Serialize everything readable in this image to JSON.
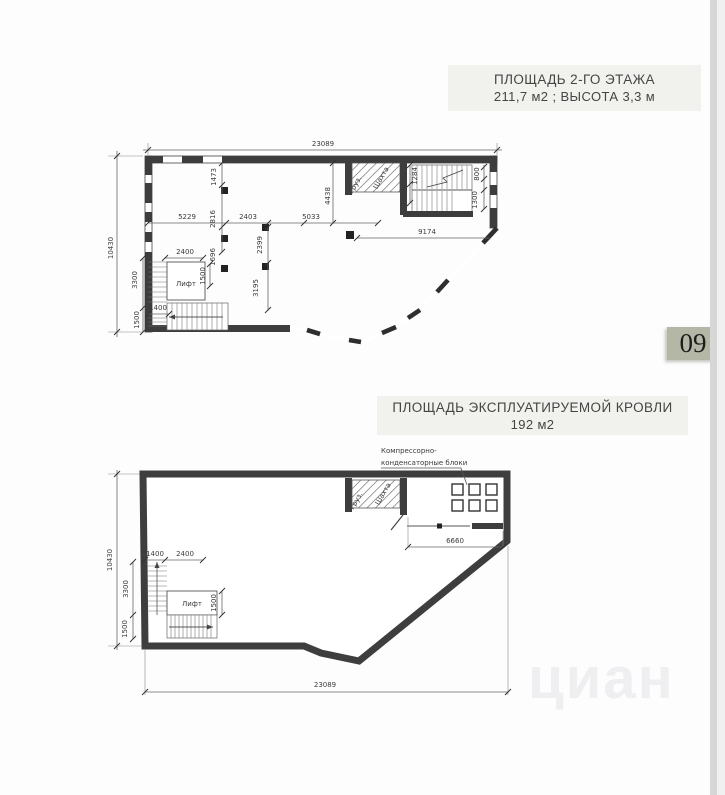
{
  "page": {
    "number": "09",
    "watermark": "циан",
    "colors": {
      "title_bg": "#f1f1ee",
      "badge_bg": "#b5b7a6",
      "wall": "#3d3d3d"
    }
  },
  "floor2": {
    "title_line1": "ПЛОЩАДЬ 2-ГО ЭТАЖА",
    "title_line2": "211,7 м2 ; ВЫСОТА 3,3 м",
    "labels": {
      "lift": "Лифт",
      "cargo": "Груз.",
      "shaft": "Шахта"
    },
    "dims": {
      "w23089": "23089",
      "h10430": "10430",
      "d5229": "5229",
      "d2816": "2816",
      "d2403": "2403",
      "d5033": "5033",
      "d1473": "1473",
      "d4438": "4438",
      "d1696": "1696",
      "d2399": "2399",
      "d3195": "3195",
      "d2400": "2400",
      "d1500": "1500",
      "d1400": "1400",
      "d3300": "3300",
      "d1284": "1284",
      "d800": "800",
      "d1300": "1300",
      "d9174": "9174"
    }
  },
  "roof": {
    "title_line1": "ПЛОЩАДЬ ЭКСПЛУАТИРУЕМОЙ КРОВЛИ",
    "title_line2": "192 м2",
    "labels": {
      "compressor1": "Компрессорно-",
      "compressor2": "конденсаторные блоки",
      "lift": "Лифт",
      "cargo": "Груз.",
      "shaft": "Шахта"
    },
    "dims": {
      "w23089": "23089",
      "h10430": "10430",
      "d6660": "6660",
      "d1400": "1400",
      "d2400": "2400",
      "d3300": "3300",
      "d1500": "1500"
    }
  }
}
